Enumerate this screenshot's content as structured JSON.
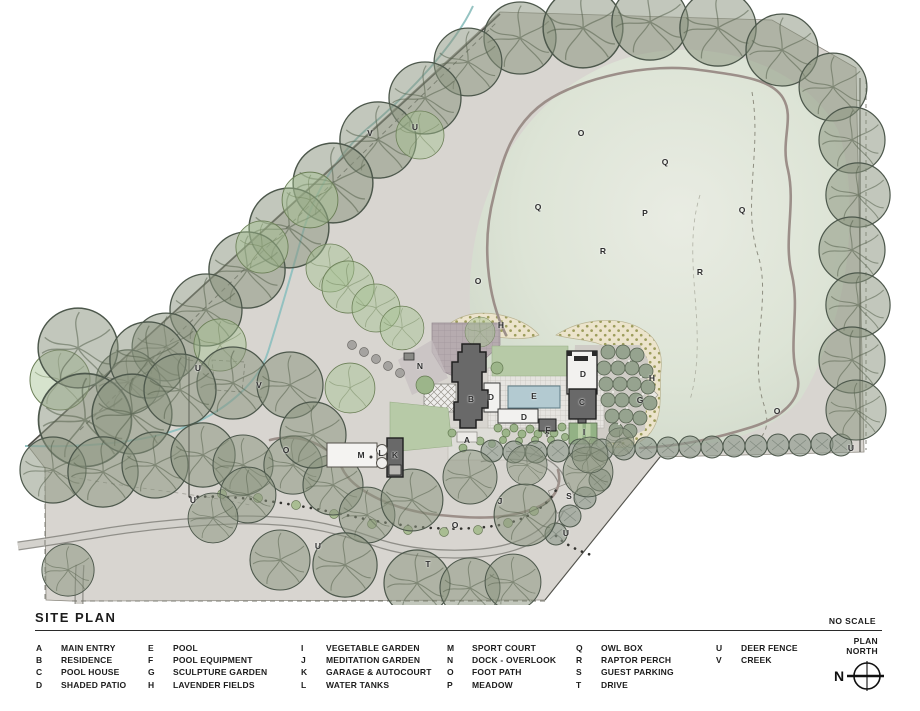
{
  "title": "SITE PLAN",
  "scale_note": "NO SCALE",
  "north_arrow": {
    "line1": "PLAN",
    "line2": "NORTH",
    "letter": "N"
  },
  "legend": {
    "columns": [
      [
        {
          "key": "A",
          "label": "MAIN ENTRY"
        },
        {
          "key": "B",
          "label": "RESIDENCE"
        },
        {
          "key": "C",
          "label": "POOL HOUSE"
        },
        {
          "key": "D",
          "label": "SHADED PATIO"
        }
      ],
      [
        {
          "key": "E",
          "label": "POOL"
        },
        {
          "key": "F",
          "label": "POOL EQUIPMENT"
        },
        {
          "key": "G",
          "label": "SCULPTURE GARDEN"
        },
        {
          "key": "H",
          "label": "LAVENDER FIELDS"
        }
      ],
      [
        {
          "key": "I",
          "label": "VEGETABLE GARDEN"
        },
        {
          "key": "J",
          "label": "MEDITATION GARDEN"
        },
        {
          "key": "K",
          "label": "GARAGE & AUTOCOURT"
        },
        {
          "key": "L",
          "label": "WATER TANKS"
        }
      ],
      [
        {
          "key": "M",
          "label": "SPORT COURT"
        },
        {
          "key": "N",
          "label": "DOCK - OVERLOOK"
        },
        {
          "key": "O",
          "label": "FOOT PATH"
        },
        {
          "key": "P",
          "label": "MEADOW"
        }
      ],
      [
        {
          "key": "Q",
          "label": "OWL BOX"
        },
        {
          "key": "R",
          "label": "RAPTOR PERCH"
        },
        {
          "key": "S",
          "label": "GUEST PARKING"
        },
        {
          "key": "T",
          "label": "DRIVE"
        }
      ],
      [
        {
          "key": "U",
          "label": "DEER FENCE"
        },
        {
          "key": "V",
          "label": "CREEK"
        }
      ]
    ]
  },
  "plan": {
    "labels": [
      {
        "t": "V",
        "x": 370,
        "y": 133
      },
      {
        "t": "U",
        "x": 415,
        "y": 127
      },
      {
        "t": "O",
        "x": 581,
        "y": 133
      },
      {
        "t": "Q",
        "x": 665,
        "y": 162
      },
      {
        "t": "Q",
        "x": 538,
        "y": 207
      },
      {
        "t": "P",
        "x": 645,
        "y": 213
      },
      {
        "t": "Q",
        "x": 742,
        "y": 210
      },
      {
        "t": "R",
        "x": 603,
        "y": 251
      },
      {
        "t": "R",
        "x": 700,
        "y": 272
      },
      {
        "t": "O",
        "x": 478,
        "y": 281
      },
      {
        "t": "H",
        "x": 501,
        "y": 325
      },
      {
        "t": "N",
        "x": 420,
        "y": 366
      },
      {
        "t": "U",
        "x": 198,
        "y": 368
      },
      {
        "t": "V",
        "x": 259,
        "y": 385
      },
      {
        "t": "B",
        "x": 471,
        "y": 399
      },
      {
        "t": "D",
        "x": 491,
        "y": 397
      },
      {
        "t": "E",
        "x": 534,
        "y": 396
      },
      {
        "t": "D",
        "x": 583,
        "y": 374
      },
      {
        "t": "C",
        "x": 582,
        "y": 402
      },
      {
        "t": "D",
        "x": 524,
        "y": 417
      },
      {
        "t": "F",
        "x": 548,
        "y": 430
      },
      {
        "t": "A",
        "x": 467,
        "y": 440
      },
      {
        "t": "I",
        "x": 584,
        "y": 432
      },
      {
        "t": "G",
        "x": 640,
        "y": 400
      },
      {
        "t": "H",
        "x": 652,
        "y": 378
      },
      {
        "t": "O",
        "x": 777,
        "y": 411
      },
      {
        "t": "U",
        "x": 851,
        "y": 448
      },
      {
        "t": "O",
        "x": 286,
        "y": 450
      },
      {
        "t": "M",
        "x": 361,
        "y": 455
      },
      {
        "t": "L",
        "x": 381,
        "y": 453
      },
      {
        "t": "K",
        "x": 395,
        "y": 455
      },
      {
        "t": "J",
        "x": 500,
        "y": 501
      },
      {
        "t": "S",
        "x": 569,
        "y": 496
      },
      {
        "t": "U",
        "x": 566,
        "y": 533
      },
      {
        "t": "U",
        "x": 193,
        "y": 500
      },
      {
        "t": "U",
        "x": 318,
        "y": 546
      },
      {
        "t": "T",
        "x": 428,
        "y": 564
      },
      {
        "t": "O",
        "x": 455,
        "y": 525
      }
    ]
  },
  "colors": {
    "land": "#d8d5d0",
    "meadow": "#ccd5c6",
    "tree": "#8a947f",
    "tree_green": "#a4c191",
    "pool": "#b3cad1",
    "building": "#696969",
    "foot_path": "#9c8f89",
    "creek": "#8fc0bf",
    "lawn": "#b7caa7",
    "lavender": "#ece4cc",
    "drive": "#d4d2cd"
  }
}
